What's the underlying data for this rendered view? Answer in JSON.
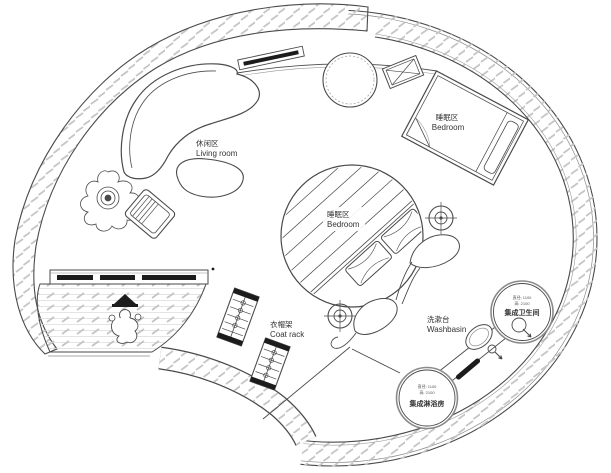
{
  "plan": {
    "title": "circular-tiny-house-floor-plan",
    "labels": {
      "living_room": {
        "zh": "休闲区",
        "en": "Living room"
      },
      "bedroom_upper": {
        "zh": "睡眠区",
        "en": "Bedroom"
      },
      "bedroom_center": {
        "zh": "睡眠区",
        "en": "Bedroom"
      },
      "coat_rack": {
        "zh": "衣帽架",
        "en": "Coat rack"
      },
      "washbasin": {
        "zh": "洗漱台",
        "en": "Washbasin"
      },
      "toilet_pod": {
        "spec1": "直径: 1100",
        "spec2": "高: 2100",
        "name": "集成卫生间"
      },
      "shower_pod": {
        "spec1": "直径: 1100",
        "spec2": "高: 2100",
        "name": "集成淋浴房"
      }
    },
    "colors": {
      "background": "#ffffff",
      "wall_line": "#4a4a4a",
      "hatch": "#c6c6c6",
      "dark_fill": "#1c1c1c",
      "text": "#333333"
    }
  }
}
